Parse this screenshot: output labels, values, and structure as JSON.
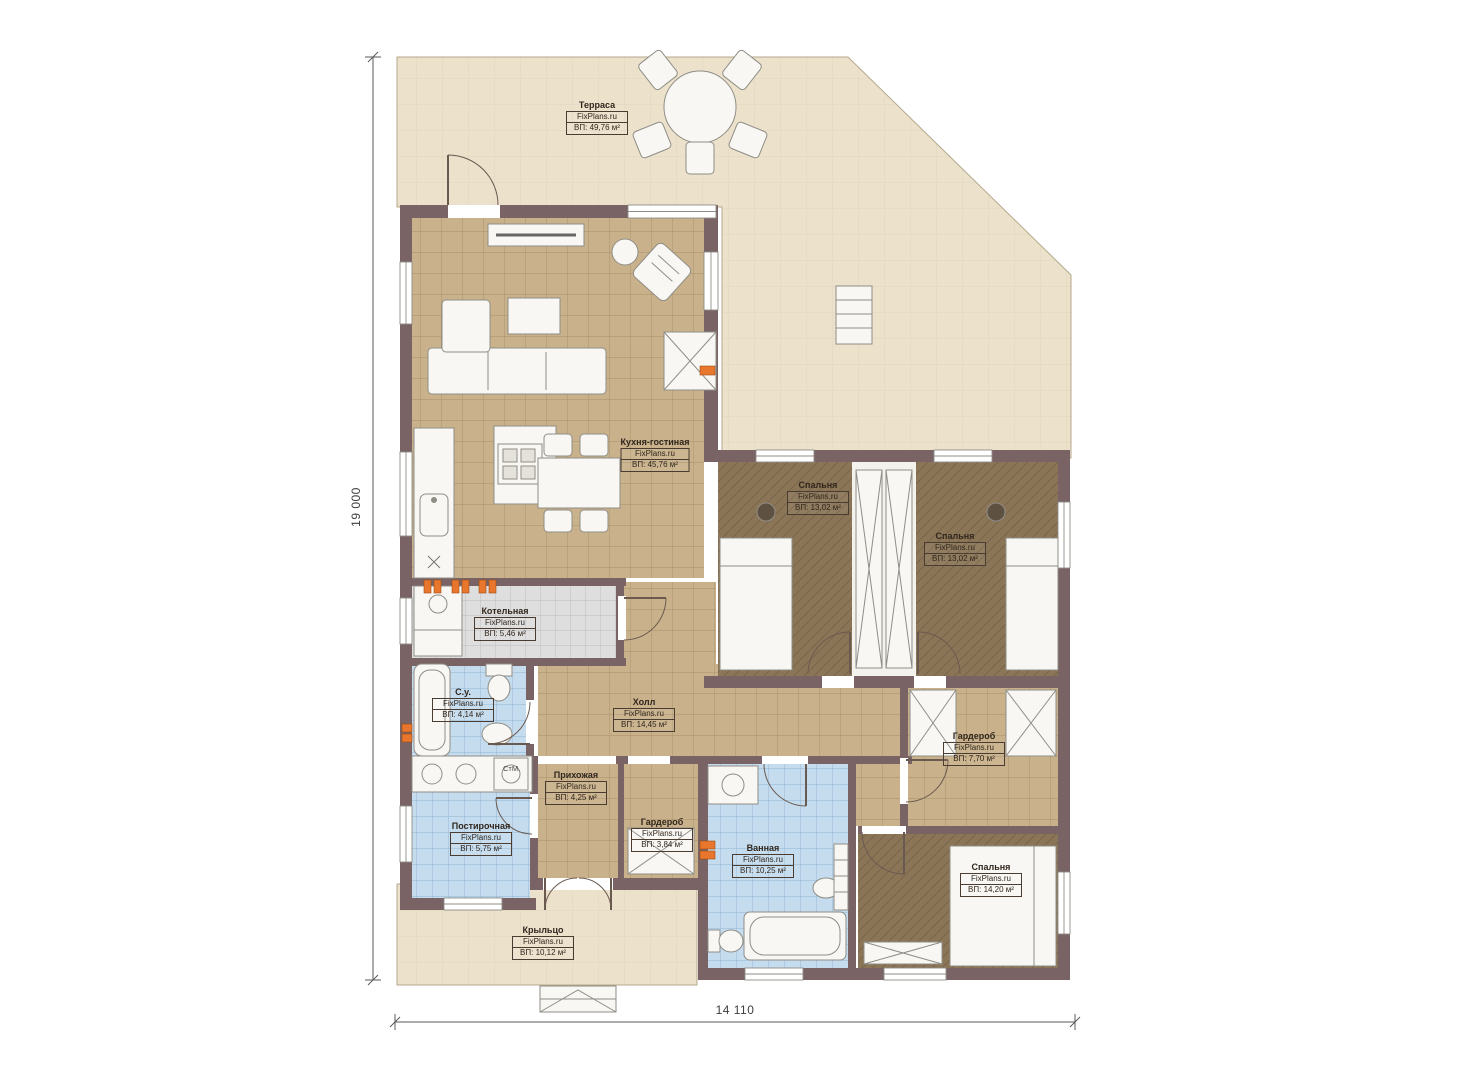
{
  "watermark": "FixPlans.ru",
  "dimensions": {
    "height": "19 000",
    "width": "14 110"
  },
  "annotations": {
    "washing_machine": "СтМ."
  },
  "rooms": {
    "terrace": {
      "name": "Терраса",
      "area": "ВП: 49,76 м²"
    },
    "kitchen_living": {
      "name": "Кухня-гостиная",
      "area": "ВП: 45,76 м²"
    },
    "boiler": {
      "name": "Котельная",
      "area": "ВП: 5,46 м²"
    },
    "wc": {
      "name": "С.у.",
      "area": "ВП: 4,14 м²"
    },
    "hall": {
      "name": "Холл",
      "area": "ВП: 14,45 м²"
    },
    "bedroom1": {
      "name": "Спальня",
      "area": "ВП: 13,02 м²"
    },
    "bedroom2": {
      "name": "Спальня",
      "area": "ВП: 13,02 м²"
    },
    "wardrobe_main": {
      "name": "Гардероб",
      "area": "ВП: 7,70 м²"
    },
    "entry": {
      "name": "Прихожая",
      "area": "ВП: 4,25 м²"
    },
    "wardrobe_small": {
      "name": "Гардероб",
      "area": "ВП: 3,84 м²"
    },
    "laundry": {
      "name": "Постирочная",
      "area": "ВП: 5,75 м²"
    },
    "bathroom": {
      "name": "Ванная",
      "area": "ВП: 10,25 м²"
    },
    "bedroom3": {
      "name": "Спальня",
      "area": "ВП: 14,20 м²"
    },
    "porch": {
      "name": "Крыльцо",
      "area": "ВП: 10,12 м²"
    }
  },
  "colors": {
    "wall": "#796365",
    "terrace": "#ece1cb",
    "tile_tan": "#c9b28b",
    "tile_blue": "#c5dcee",
    "tile_gray": "#dedede",
    "carpet": "#8b7557",
    "radiator": "#e8762c"
  }
}
